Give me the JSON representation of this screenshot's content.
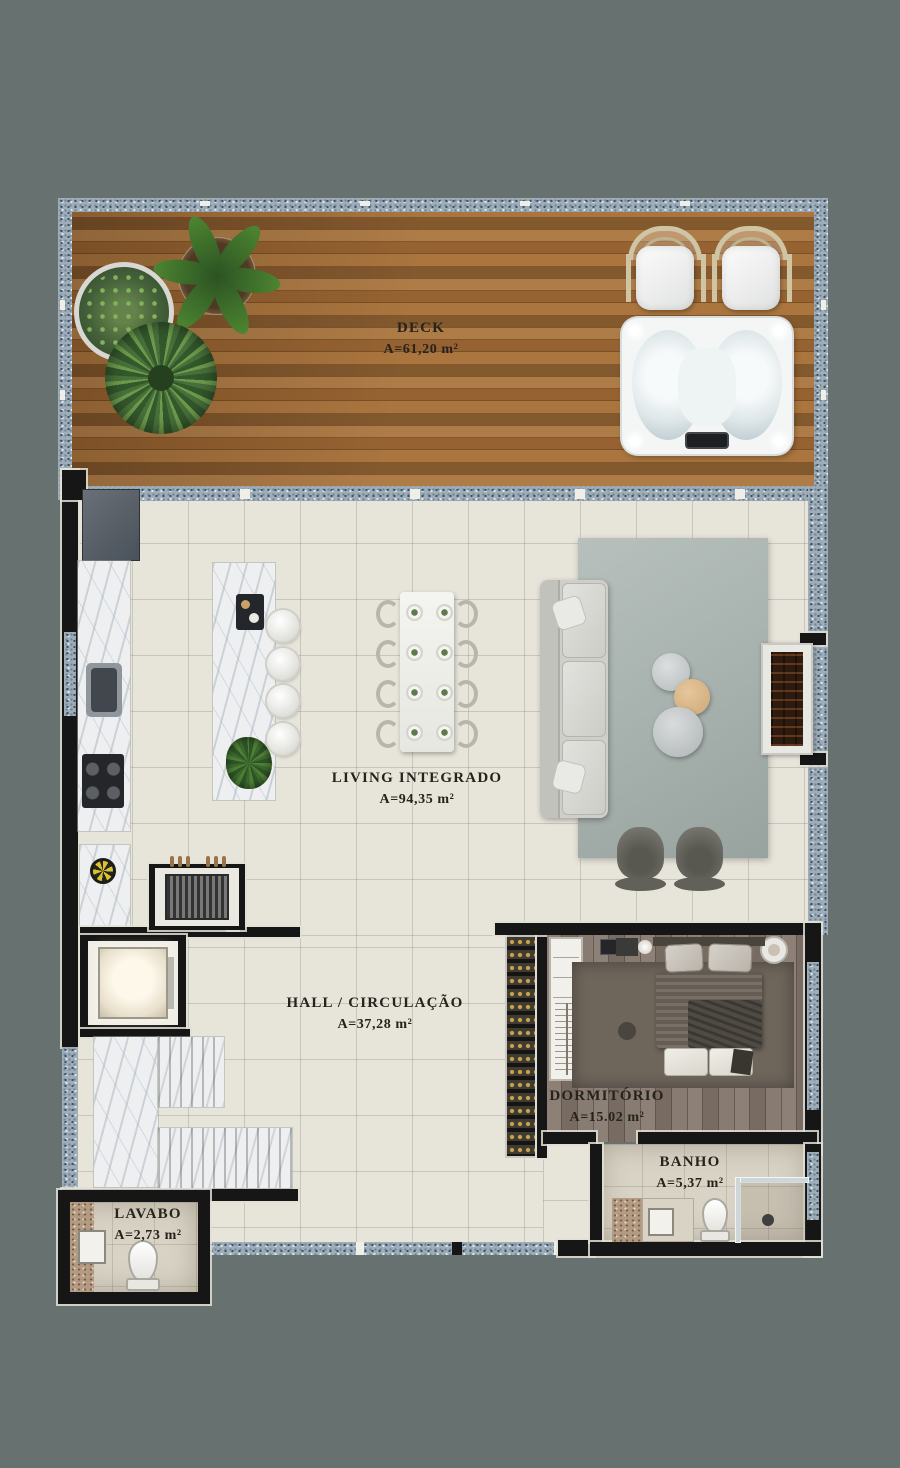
{
  "page": {
    "title": "Apartment floor plan — rendered top view"
  },
  "background_color": "#667170",
  "label_color": "#26221c",
  "rooms": {
    "deck": {
      "name": "DECK",
      "area": "A=61,20 m²"
    },
    "living": {
      "name": "LIVING INTEGRADO",
      "area": "A=94,35 m²"
    },
    "hall": {
      "name": "HALL / CIRCULAÇÃO",
      "area": "A=37,28 m²"
    },
    "dormitorio": {
      "name": "DORMITÓRIO",
      "area": "A=15.02 m²"
    },
    "banho": {
      "name": "BANHO",
      "area": "A=5,37 m²"
    },
    "lavabo": {
      "name": "LAVABO",
      "area": "A=2,73 m²"
    }
  },
  "materials": {
    "deck_wood": "#a06c38",
    "window_stone": "#9fadb8",
    "tile_floor": "#e7e5da",
    "wall": "#161616",
    "bedroom_wood": "#82746a",
    "living_rug": "#a9b3af",
    "marble": "#edeff0",
    "side_table_accent": "#dcb98e"
  },
  "furniture": [
    "potted-plants",
    "lounge-chairs",
    "hot-tub",
    "refrigerator",
    "kitchen-sink",
    "cooktop",
    "kitchen-island",
    "bar-stools",
    "dining-table",
    "dining-chairs",
    "sofa",
    "coffee-tables",
    "armchairs",
    "fireplace",
    "barbecue-grill",
    "elevator",
    "staircase",
    "wine-rack",
    "double-bed",
    "closet",
    "nightstands",
    "bathroom-vanity",
    "toilet",
    "shower",
    "washbasin"
  ]
}
